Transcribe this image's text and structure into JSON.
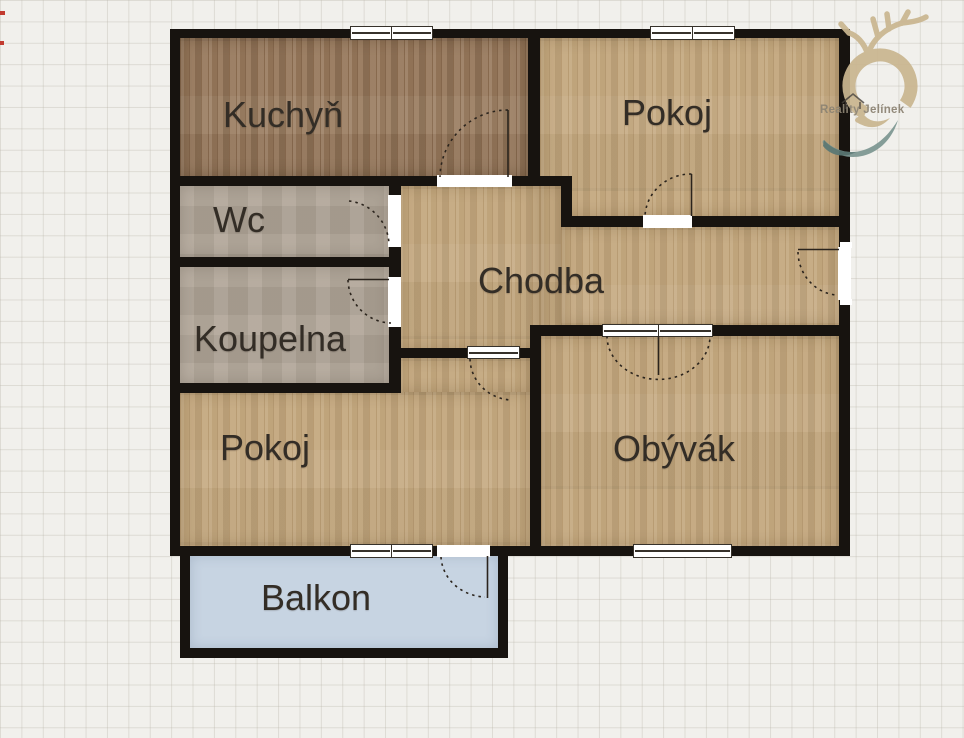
{
  "plan": {
    "rooms": [
      {
        "id": "kuchyn",
        "label": "Kuchyň"
      },
      {
        "id": "pokoj_top",
        "label": "Pokoj"
      },
      {
        "id": "wc",
        "label": "Wc"
      },
      {
        "id": "koupelna",
        "label": "Koupelna"
      },
      {
        "id": "chodba",
        "label": "Chodba"
      },
      {
        "id": "pokoj_bottom",
        "label": "Pokoj"
      },
      {
        "id": "obyvak",
        "label": "Obývák"
      },
      {
        "id": "balkon",
        "label": "Balkon"
      }
    ]
  },
  "logo": {
    "text": "Reality Jelínek"
  },
  "palette": {
    "wall": "#17130f",
    "wood_light": "#c3a77d",
    "wood_dark": "#96775a",
    "tile": "#b0a597",
    "balcony": "#c7d4e2",
    "label_text": "#332d26",
    "logo_beige": "#cab690",
    "logo_teal": "#7d9792",
    "logo_teal_dark": "#5a7874",
    "logo_text_color": "#8c8373",
    "grid_paper": "#f1f0ec"
  }
}
